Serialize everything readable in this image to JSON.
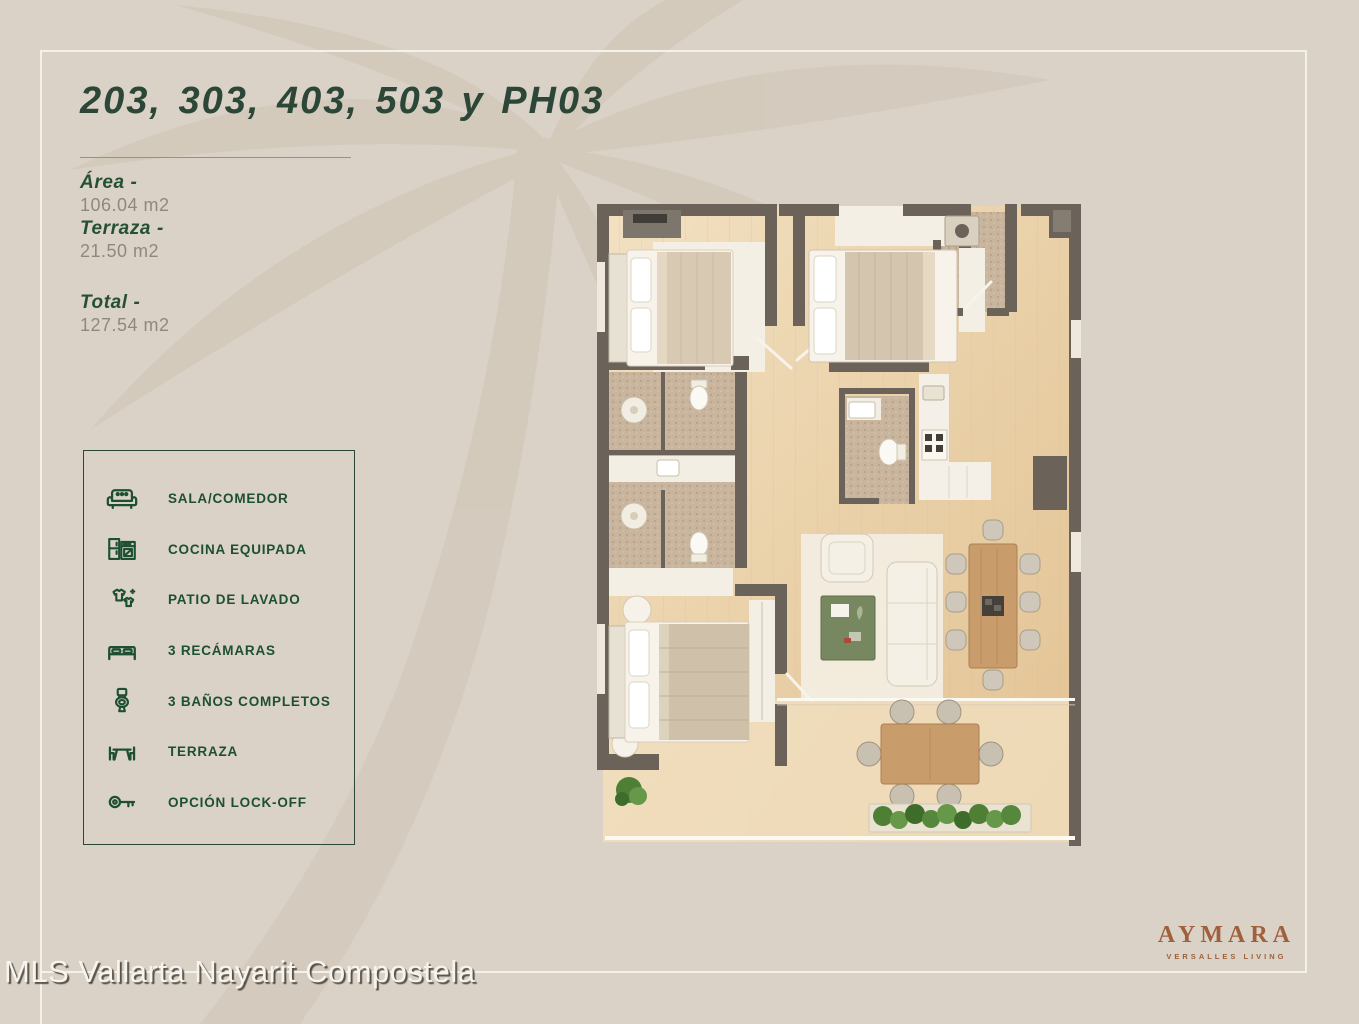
{
  "page": {
    "background_color": "#dad2c6",
    "frame_color": "#f4f1e9",
    "watermark_text": "MLS Vallarta Nayarit Compostela"
  },
  "header": {
    "title": "203, 303, 403, 503 y PH03",
    "title_color": "#2c4738"
  },
  "specs": [
    {
      "label": "Área -",
      "value": "106.04 m2"
    },
    {
      "label": "Terraza -",
      "value": "21.50 m2"
    },
    {
      "label": "Total -",
      "value": "127.54 m2"
    }
  ],
  "legend": {
    "border_color": "#2c4738",
    "items": [
      {
        "icon": "sofa-icon",
        "label": "SALA/COMEDOR"
      },
      {
        "icon": "kitchen-icon",
        "label": "COCINA EQUIPADA"
      },
      {
        "icon": "laundry-icon",
        "label": "PATIO DE LAVADO"
      },
      {
        "icon": "bed-icon",
        "label": "3 RECÁMARAS"
      },
      {
        "icon": "toilet-icon",
        "label": "3 BAÑOS COMPLETOS"
      },
      {
        "icon": "terrace-icon",
        "label": "TERRAZA"
      },
      {
        "icon": "key-icon",
        "label": "OPCIÓN LOCK-OFF"
      }
    ]
  },
  "floor_plan": {
    "alt": "Top-view 3D render of unit floor plan: three bedrooms, three full bathrooms, kitchen, living-dining room, laundry patio and terrace with outdoor dining"
  },
  "brand": {
    "name": "AYMARA",
    "tagline": "VERSALLES LIVING",
    "color": "#a0603c"
  }
}
